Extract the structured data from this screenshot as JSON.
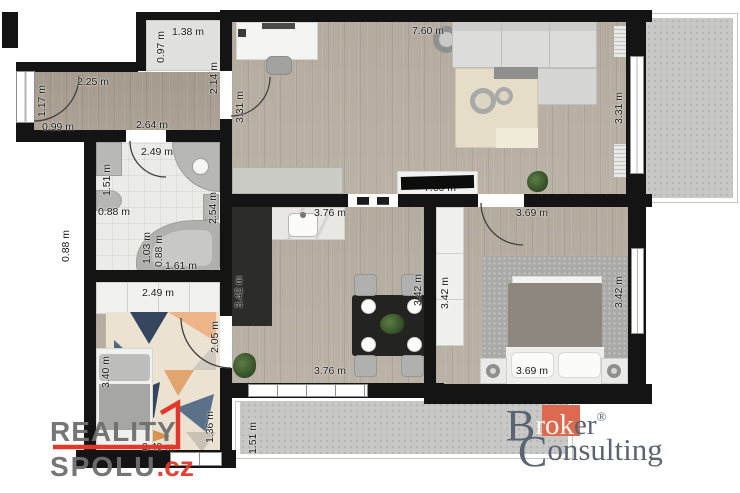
{
  "branding": {
    "reality_spolu": {
      "line1": "REALITY",
      "line2": "SPOLU",
      "tld": ".cz"
    },
    "broker_consulting": {
      "word1_cap": "B",
      "word1_mid": "rok",
      "word1_end": "er",
      "reg": "®",
      "word2_cap": "C",
      "word2_rest": "onsulting"
    }
  },
  "colors": {
    "wall": "#141414",
    "accent_red": "#e2382c",
    "logo_gray": "#6f6f6f",
    "broker_orange": "#dd6a50",
    "broker_gray": "#5b6472"
  },
  "units": "m",
  "dimension_labels": [
    {
      "text": "1.38 m",
      "x": 188,
      "y": 32,
      "rot": false
    },
    {
      "text": "0.97 m",
      "x": 161,
      "y": 47,
      "rot": true
    },
    {
      "text": "2.25 m",
      "x": 93,
      "y": 82,
      "rot": false
    },
    {
      "text": "1.17 m",
      "x": 42,
      "y": 101,
      "rot": true
    },
    {
      "text": "0.99 m",
      "x": 58,
      "y": 127,
      "rot": false
    },
    {
      "text": "2.64 m",
      "x": 152,
      "y": 125,
      "rot": false
    },
    {
      "text": "2.14 m",
      "x": 214,
      "y": 78,
      "rot": true
    },
    {
      "text": "3.31 m",
      "x": 240,
      "y": 107,
      "rot": true
    },
    {
      "text": "7.60 m",
      "x": 428,
      "y": 31,
      "rot": false
    },
    {
      "text": "3.31 m",
      "x": 619,
      "y": 108,
      "rot": true
    },
    {
      "text": "7.60 m",
      "x": 440,
      "y": 188,
      "rot": false
    },
    {
      "text": "2.49 m",
      "x": 157,
      "y": 152,
      "rot": false
    },
    {
      "text": "1.51 m",
      "x": 107,
      "y": 180,
      "rot": true
    },
    {
      "text": "0.88 m",
      "x": 114,
      "y": 212,
      "rot": false
    },
    {
      "text": "2.54 m",
      "x": 213,
      "y": 208,
      "rot": true
    },
    {
      "text": "1.03 m",
      "x": 147,
      "y": 248,
      "rot": true
    },
    {
      "text": "0.88 m",
      "x": 159,
      "y": 251,
      "rot": true
    },
    {
      "text": "1.61 m",
      "x": 181,
      "y": 266,
      "rot": false
    },
    {
      "text": "0.88 m",
      "x": 66,
      "y": 246,
      "rot": true
    },
    {
      "text": "2.49 m",
      "x": 158,
      "y": 293,
      "rot": false
    },
    {
      "text": "3.40 m",
      "x": 106,
      "y": 372,
      "rot": true
    },
    {
      "text": "2.05 m",
      "x": 215,
      "y": 337,
      "rot": true
    },
    {
      "text": "1.36 m",
      "x": 210,
      "y": 427,
      "rot": true
    },
    {
      "text": "2.49 m",
      "x": 158,
      "y": 447,
      "rot": false
    },
    {
      "text": "3.76 m",
      "x": 330,
      "y": 213,
      "rot": false
    },
    {
      "text": "3.42 m",
      "x": 239,
      "y": 292,
      "rot": true
    },
    {
      "text": "3.42 m",
      "x": 418,
      "y": 290,
      "rot": true
    },
    {
      "text": "3.42 m",
      "x": 445,
      "y": 293,
      "rot": true
    },
    {
      "text": "3.42 m",
      "x": 619,
      "y": 292,
      "rot": true
    },
    {
      "text": "3.76 m",
      "x": 330,
      "y": 371,
      "rot": false
    },
    {
      "text": "3.69 m",
      "x": 532,
      "y": 213,
      "rot": false
    },
    {
      "text": "3.69 m",
      "x": 532,
      "y": 371,
      "rot": false
    },
    {
      "text": "1.51 m",
      "x": 253,
      "y": 438,
      "rot": true
    }
  ]
}
